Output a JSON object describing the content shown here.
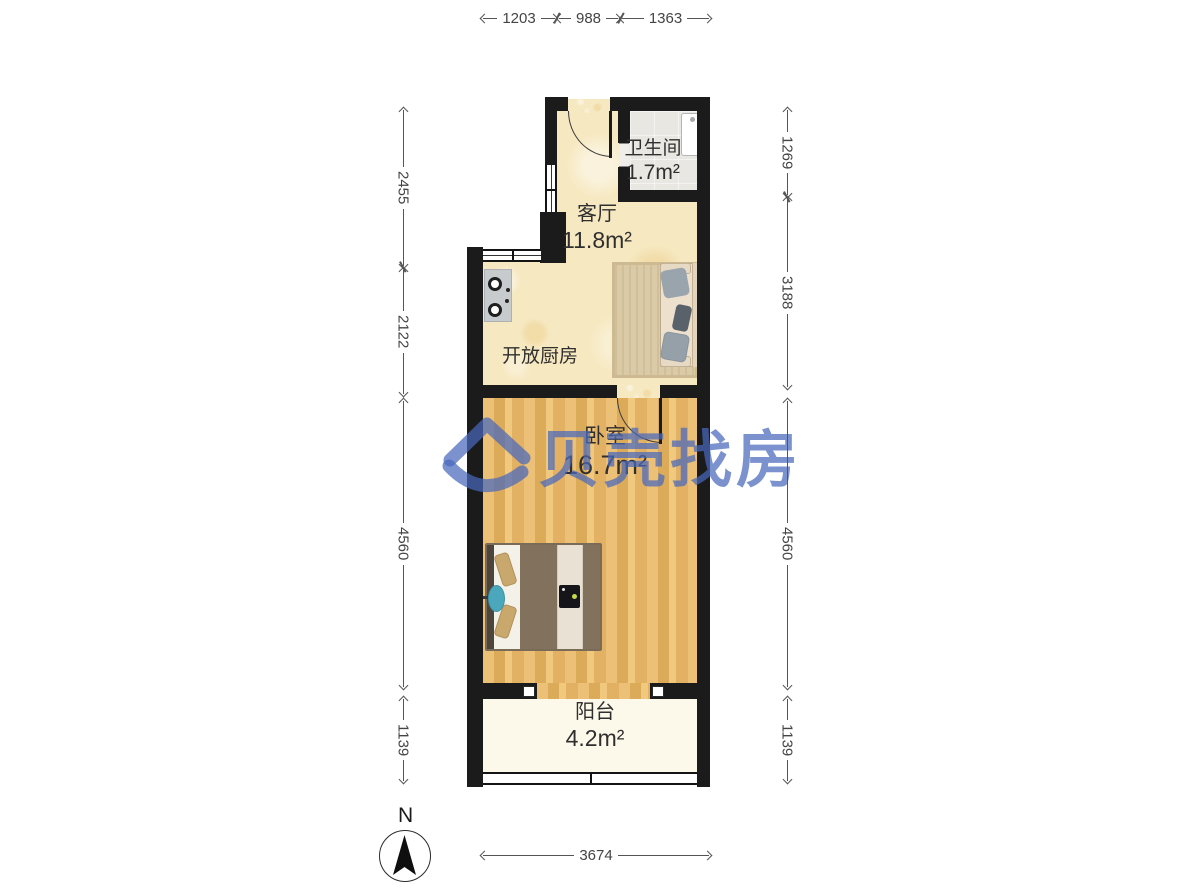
{
  "brand": {
    "watermark_text": "贝壳找房"
  },
  "compass": {
    "label": "N"
  },
  "rooms": {
    "living": {
      "name": "客厅",
      "area": "11.8m²"
    },
    "bathroom": {
      "name": "卫生间",
      "area": "1.7m²"
    },
    "kitchen": {
      "name": "开放厨房"
    },
    "bedroom": {
      "name": "卧室",
      "area": "16.7m²"
    },
    "balcony": {
      "name": "阳台",
      "area": "4.2m²"
    }
  },
  "dims": {
    "top": [
      "1203",
      "988",
      "1363"
    ],
    "left": [
      "2455",
      "2122",
      "4560",
      "1139"
    ],
    "right": [
      "1269",
      "3188",
      "4560",
      "1139"
    ],
    "bottom": [
      "3674"
    ]
  },
  "icons": {
    "stove": "stove-icon",
    "sofa": "sofa-icon",
    "bed": "bed-icon",
    "sink": "sink-icon",
    "compass": "compass-icon",
    "watermark_logo": "watermark-logo-icon"
  },
  "colors": {
    "wall": "#1B1B1B",
    "floor_main": "#F6E8C0",
    "floor_wood": "#E5B669",
    "floor_bath": "#E9E7E2",
    "floor_balcony": "#FCF9EB",
    "watermark_blue": "#4868BC",
    "dim_gray": "#555555"
  }
}
